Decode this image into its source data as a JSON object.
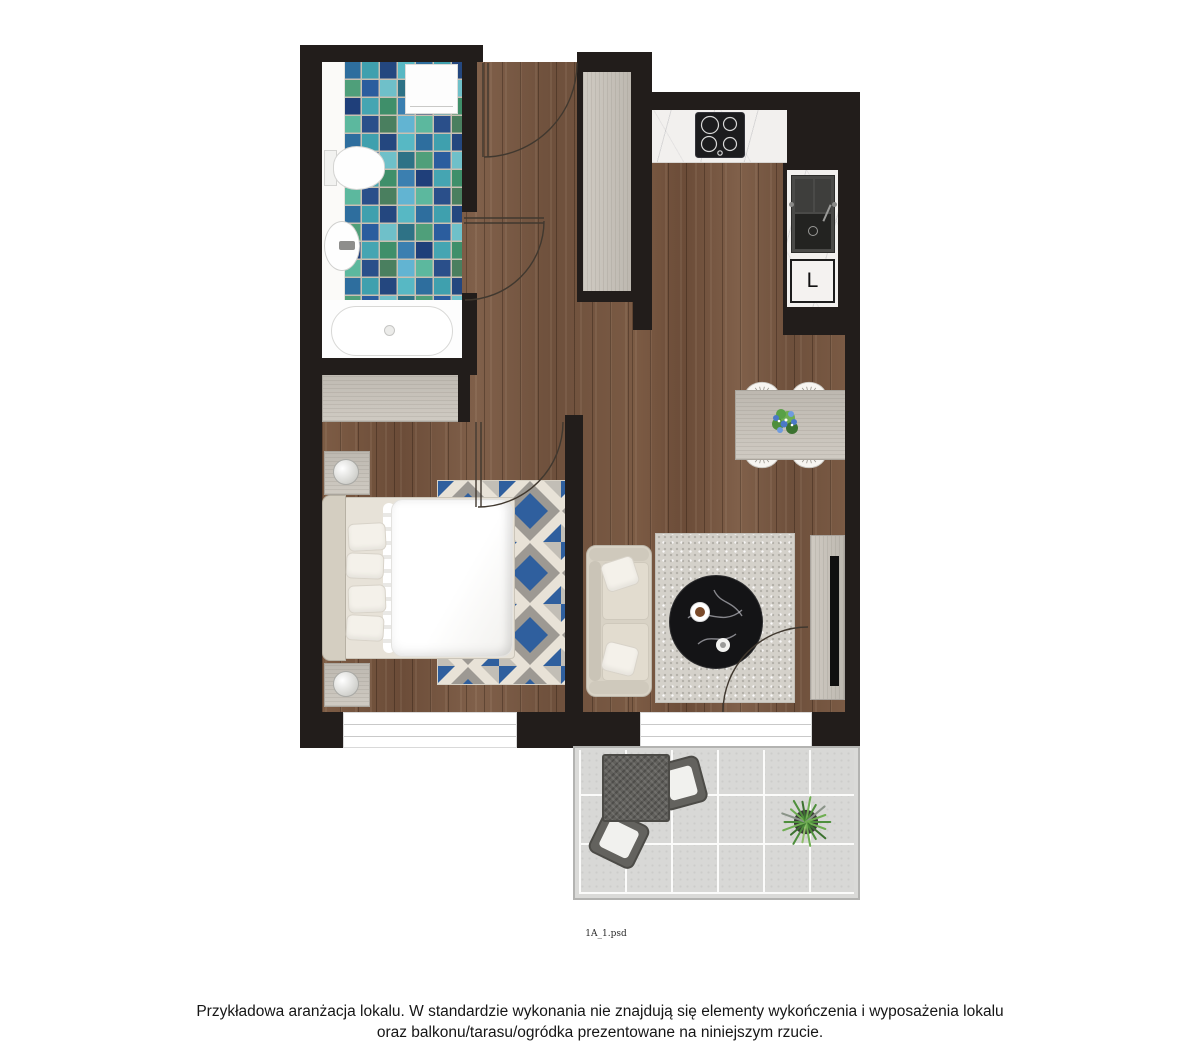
{
  "plan": {
    "filename": "1A_1.psd",
    "fridge_label": "L"
  },
  "footer": {
    "disclaimer_line1": "Przykładowa aranżacja lokalu. W standardzie wykonania nie znajdują się elementy wykończenia i wyposażenia lokalu",
    "disclaimer_line2": "oraz balkonu/tarasu/ogródka prezentowane na niniejszym rzucie."
  },
  "colors": {
    "wall": "#221d1b",
    "wood_floor": "#74543f",
    "gray_wood": "#c8c3bb",
    "marble": "#f2f0ee",
    "mosaic_blue": "#2b5d9e",
    "mosaic_teal": "#3fa0ae",
    "rug_blue": "#2f5f9e",
    "balcony_tile": "#d8d8d6"
  }
}
